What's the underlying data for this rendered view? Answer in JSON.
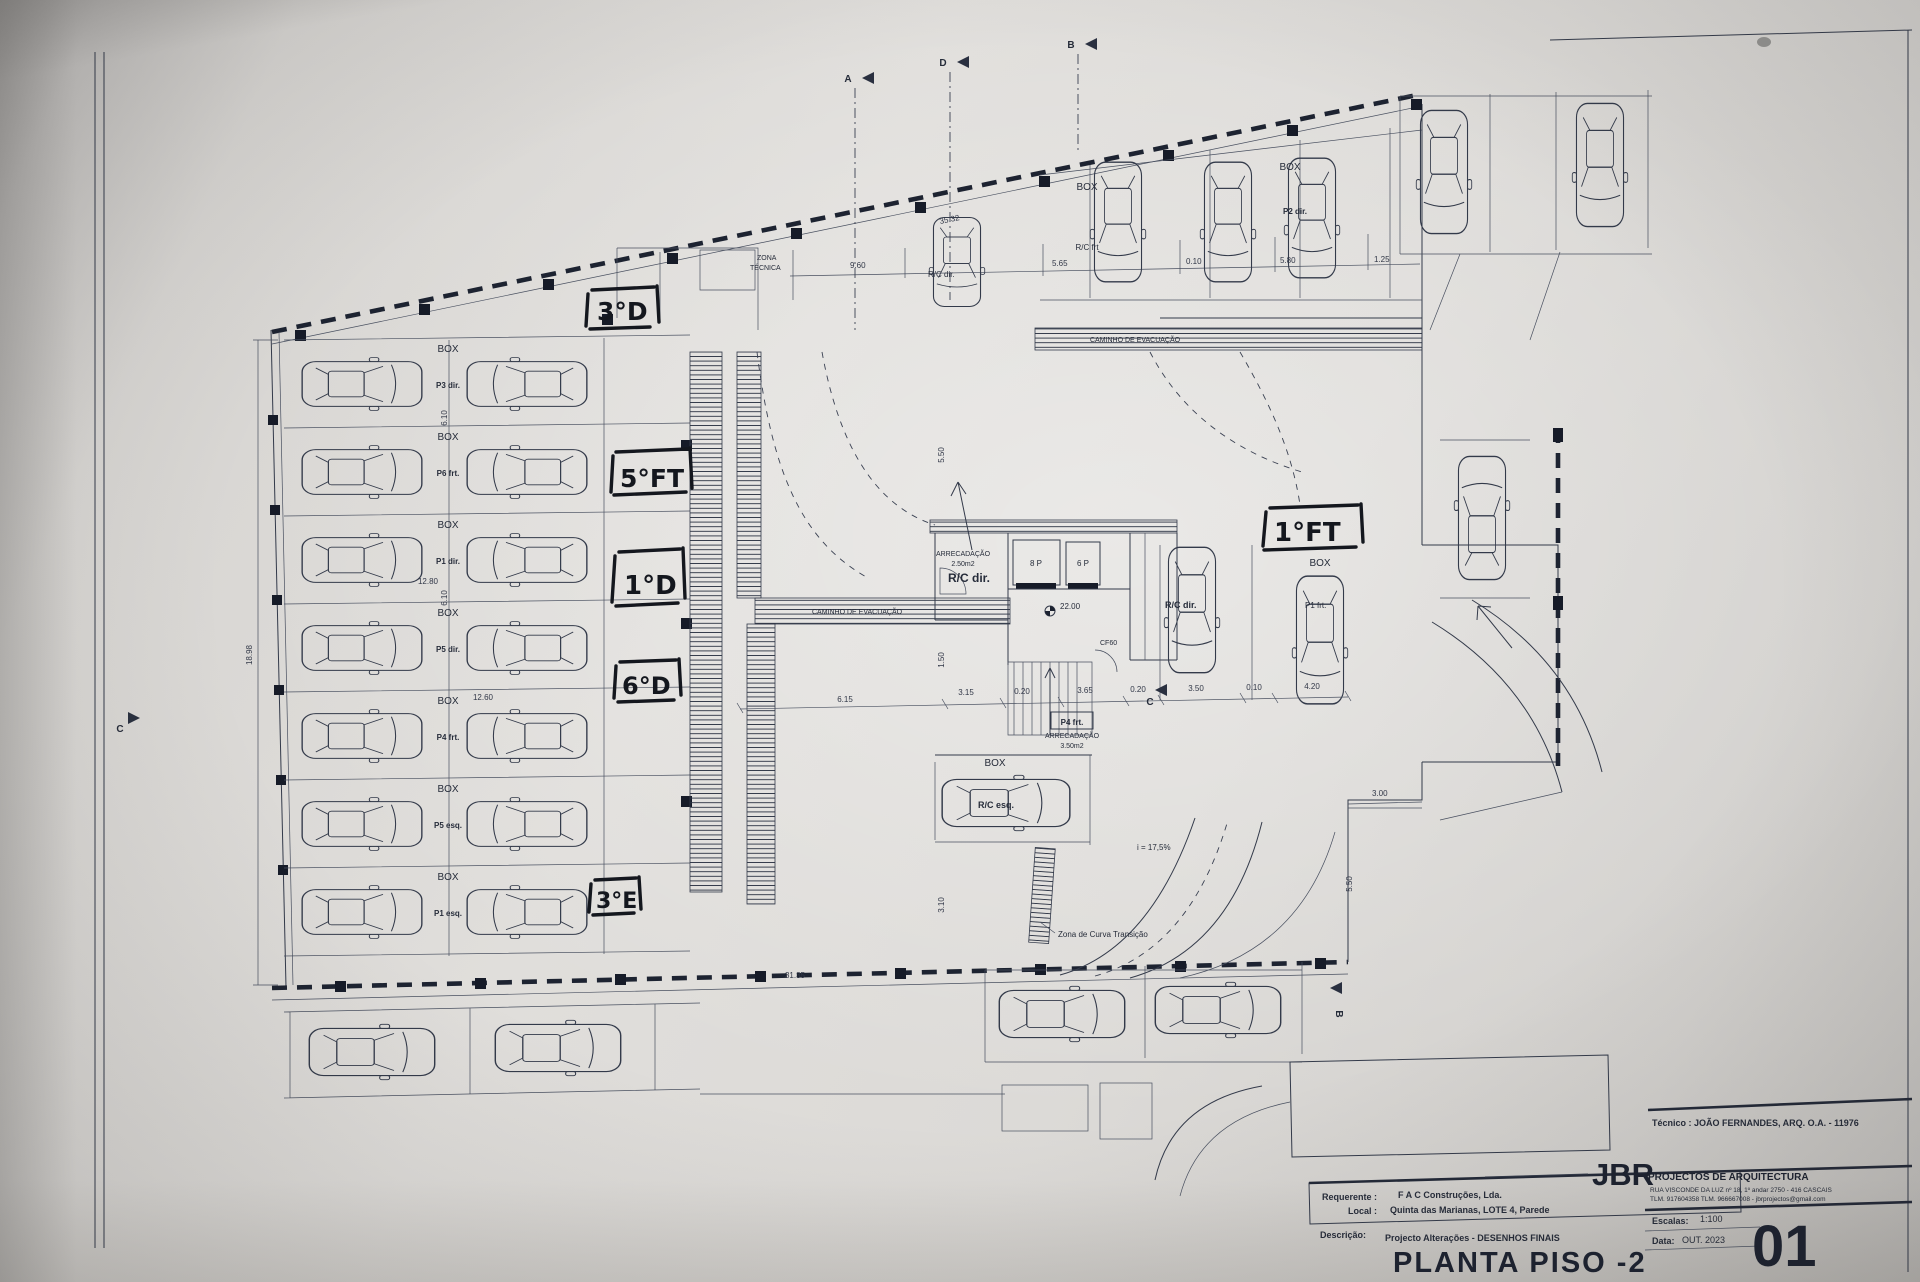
{
  "plan": {
    "handwritten": {
      "top": "3°D",
      "mid1": "5°FT",
      "mid2": "1°D",
      "mid3": "6°D",
      "bottom": "3°E",
      "right": "1°FT"
    },
    "labels": {
      "zona1": "ZONA",
      "zona2": "TÉCNICA",
      "caminho": "CAMINHO DE EVACUAÇÃO",
      "box": "BOX",
      "rc_frt": "R/C frt",
      "rc_dir": "R/C dir.",
      "rc_esq": "R/C esq.",
      "p2_dir": "P2 dir.",
      "p1_frt": "P1 frt.",
      "arrecadacao": "ARRECADAÇÃO",
      "area_small": "2.50m2",
      "area_big": "3.50m2",
      "p4_frt": "P4 frt.",
      "elev_left": "8 P",
      "elev_right": "6 P",
      "level": "22.00",
      "cf": "CF60",
      "slope": "i = 17,5%",
      "curva": "Zona de Curva Transição"
    },
    "stalls": [
      {
        "label": "P3 dir."
      },
      {
        "label": "P6 frt."
      },
      {
        "label": "P1 dir."
      },
      {
        "label": "P5 dir."
      },
      {
        "label": "P4 frt."
      },
      {
        "label": "P5 esq."
      },
      {
        "label": "P1 esq."
      }
    ],
    "dims": {
      "top": "35.32",
      "t960": "9.60",
      "t565": "5.65",
      "t010": "0.10",
      "t580": "5.80",
      "t125": "1.25",
      "mid1280": "12.80",
      "mid1260": "12.60",
      "c615": "6.15",
      "c315": "3.15",
      "c020a": "0.20",
      "c365": "3.65",
      "c020b": "0.20",
      "c350": "3.50",
      "c010": "0.10",
      "c420": "4.20",
      "r300": "3.00",
      "r550": "5.50",
      "v550": "5.50",
      "v150": "1.50",
      "v310": "3.10",
      "bottom": "31.35",
      "left": "18.98",
      "s610a": "6.10",
      "s610b": "6.10"
    },
    "sections": {
      "a": "A",
      "d": "D",
      "b": "B",
      "b2": "B",
      "c": "C",
      "c2": "C"
    }
  },
  "titleblock": {
    "tecnico": "Técnico : JOÃO FERNANDES, ARQ.   O.A. - 11976",
    "requerente_label": "Requerente :",
    "requerente": "F A C  Construções, Lda.",
    "local_label": "Local :",
    "local": "Quinta das Marianas, LOTE 4, Parede",
    "descricao_label": "Descrição:",
    "descricao": "Projecto Alterações - DESENHOS FINAIS",
    "title": "PLANTA PISO -2",
    "firm_short": "JBR",
    "firm_rest": "PROJECTOS DE ARQUITECTURA",
    "firm_addr": "RUA VISCONDE DA LUZ nº 18, 1º andar  2750 - 416  CASCAIS",
    "firm_tel": "TLM. 917604358 TLM. 966667008 - jbrprojectos@gmail.com",
    "escala_label": "Escalas:",
    "escala": "1:100",
    "data_label": "Data:",
    "data": "OUT. 2023",
    "sheet_no": "01"
  }
}
